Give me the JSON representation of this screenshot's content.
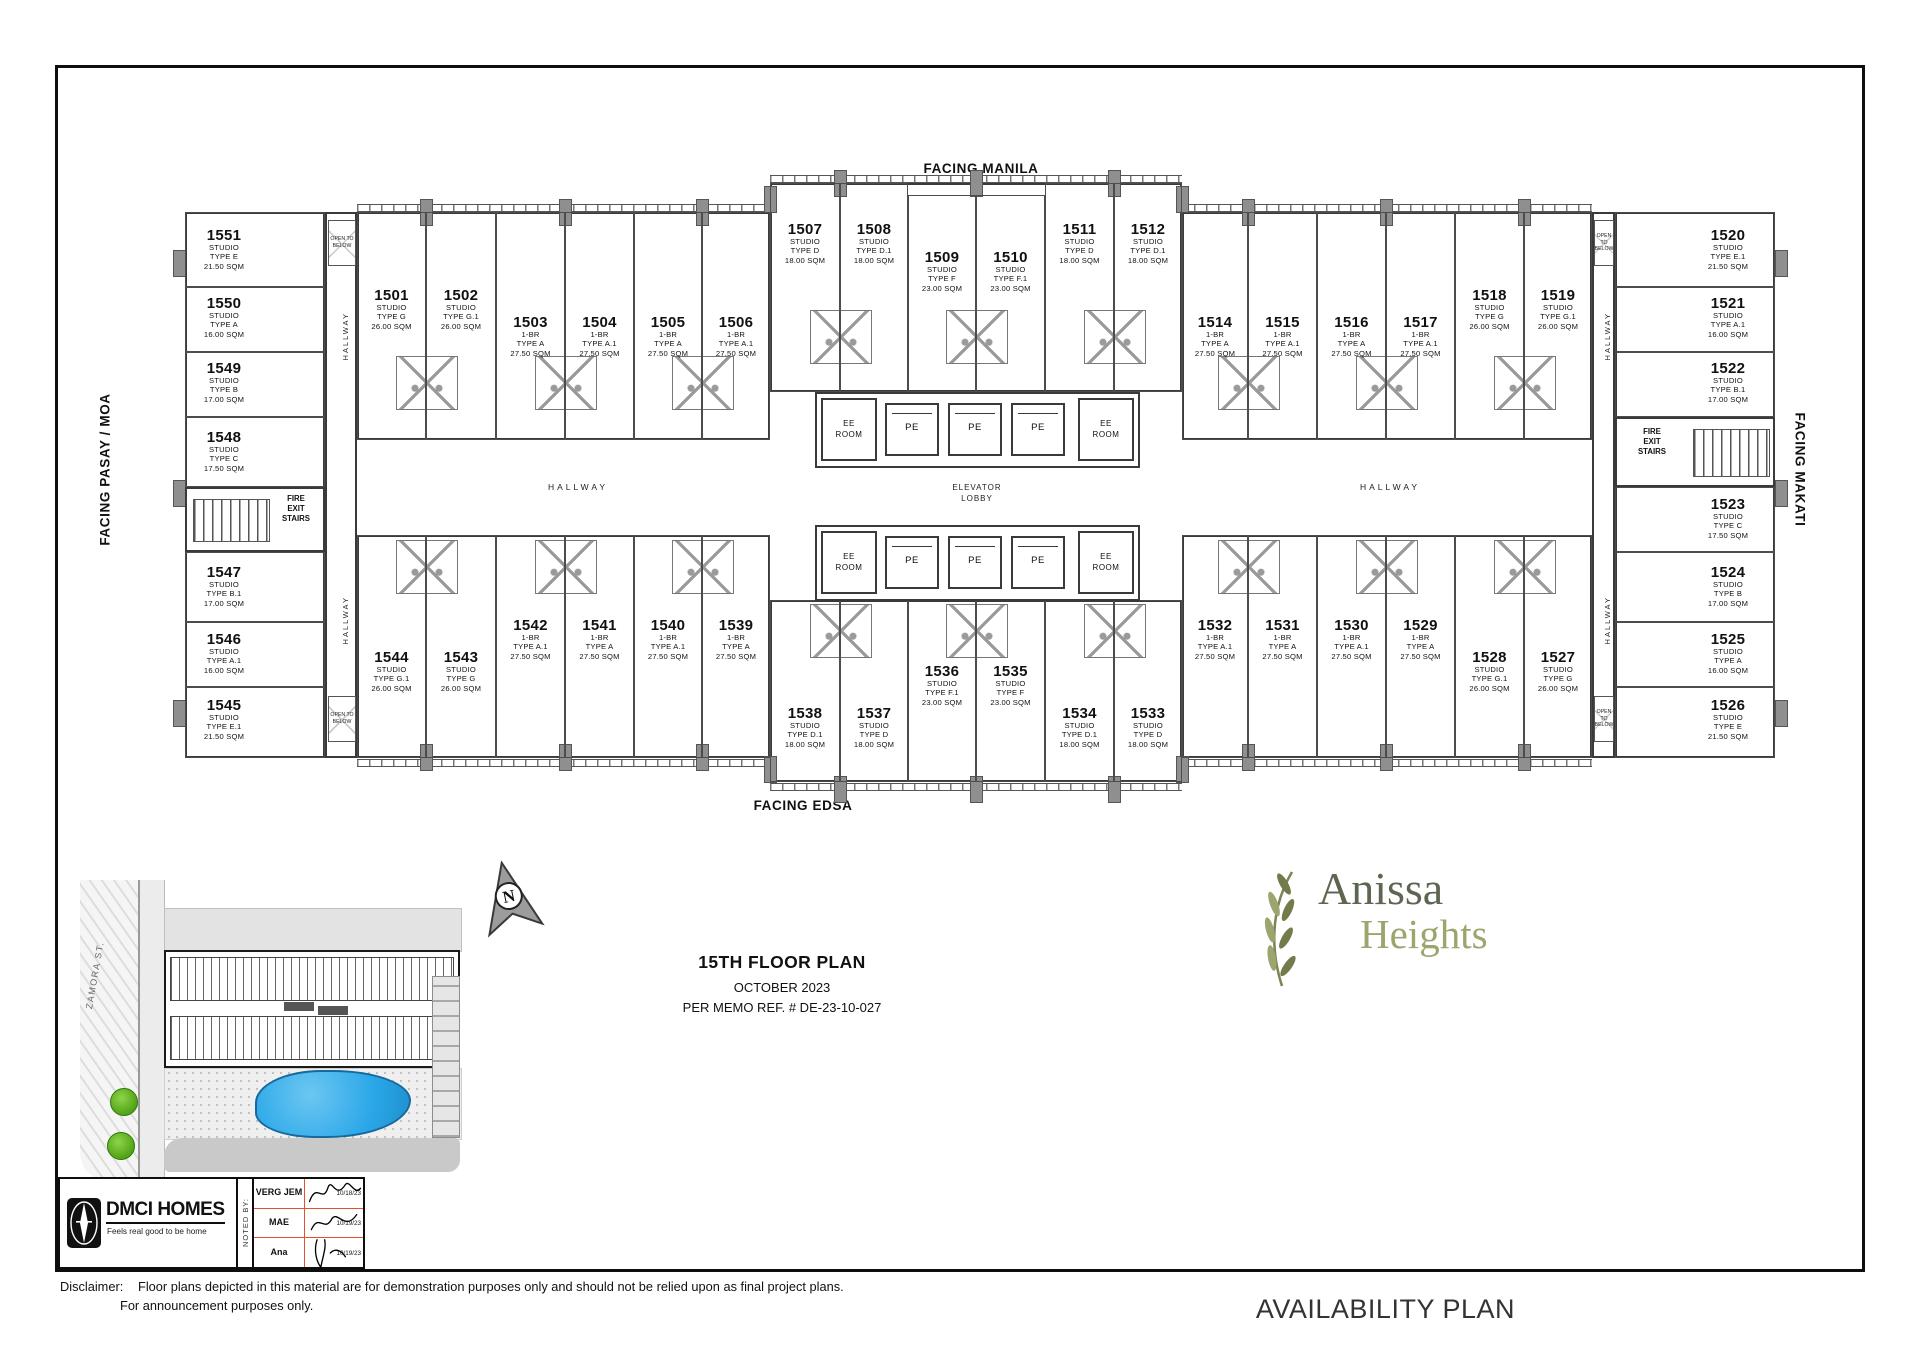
{
  "plan": {
    "facing": {
      "top": "FACING MANILA",
      "bottom": "FACING EDSA",
      "left": "FACING PASAY / MOA",
      "right": "FACING MAKATI"
    },
    "hallway_label": "HALLWAY",
    "elevator_lobby": [
      "ELEVATOR",
      "LOBBY"
    ],
    "ee_room": [
      "EE",
      "ROOM"
    ],
    "pe": "PE",
    "fire_exit_stairs": [
      "FIRE",
      "EXIT",
      "STAIRS"
    ],
    "open_to_below": [
      "OPEN",
      "TO",
      "BELOW"
    ],
    "units": [
      {
        "no": "1501",
        "t": [
          "STUDIO",
          "TYPE G",
          "26.00 SQM"
        ],
        "x": 357,
        "y": 212,
        "w": 69,
        "h": 228,
        "ly": 288
      },
      {
        "no": "1502",
        "t": [
          "STUDIO",
          "TYPE G.1",
          "26.00 SQM"
        ],
        "x": 426,
        "y": 212,
        "w": 70,
        "h": 228,
        "ly": 288
      },
      {
        "no": "1503",
        "t": [
          "1-BR",
          "TYPE A",
          "27.50 SQM"
        ],
        "x": 496,
        "y": 212,
        "w": 69,
        "h": 228,
        "ly": 315
      },
      {
        "no": "1504",
        "t": [
          "1-BR",
          "TYPE A.1",
          "27.50 SQM"
        ],
        "x": 565,
        "y": 212,
        "w": 69,
        "h": 228,
        "ly": 315
      },
      {
        "no": "1505",
        "t": [
          "1-BR",
          "TYPE A",
          "27.50 SQM"
        ],
        "x": 634,
        "y": 212,
        "w": 68,
        "h": 228,
        "ly": 315
      },
      {
        "no": "1506",
        "t": [
          "1-BR",
          "TYPE A.1",
          "27.50 SQM"
        ],
        "x": 702,
        "y": 212,
        "w": 68,
        "h": 228,
        "ly": 315
      },
      {
        "no": "1507",
        "t": [
          "STUDIO",
          "TYPE D",
          "18.00 SQM"
        ],
        "x": 770,
        "y": 183,
        "w": 70,
        "h": 209,
        "ly": 222
      },
      {
        "no": "1508",
        "t": [
          "STUDIO",
          "TYPE D.1",
          "18.00 SQM"
        ],
        "x": 840,
        "y": 183,
        "w": 68,
        "h": 209,
        "ly": 222
      },
      {
        "no": "1509",
        "t": [
          "STUDIO",
          "TYPE F",
          "23.00 SQM"
        ],
        "x": 908,
        "y": 195,
        "w": 68,
        "h": 197,
        "ly": 250
      },
      {
        "no": "1510",
        "t": [
          "STUDIO",
          "TYPE F.1",
          "23.00 SQM"
        ],
        "x": 976,
        "y": 195,
        "w": 69,
        "h": 197,
        "ly": 250
      },
      {
        "no": "1511",
        "t": [
          "STUDIO",
          "TYPE D",
          "18.00 SQM"
        ],
        "x": 1045,
        "y": 183,
        "w": 69,
        "h": 209,
        "ly": 222
      },
      {
        "no": "1512",
        "t": [
          "STUDIO",
          "TYPE D.1",
          "18.00 SQM"
        ],
        "x": 1114,
        "y": 183,
        "w": 68,
        "h": 209,
        "ly": 222
      },
      {
        "no": "1514",
        "t": [
          "1-BR",
          "TYPE A",
          "27.50 SQM"
        ],
        "x": 1182,
        "y": 212,
        "w": 66,
        "h": 228,
        "ly": 315
      },
      {
        "no": "1515",
        "t": [
          "1-BR",
          "TYPE A.1",
          "27.50 SQM"
        ],
        "x": 1248,
        "y": 212,
        "w": 69,
        "h": 228,
        "ly": 315
      },
      {
        "no": "1516",
        "t": [
          "1-BR",
          "TYPE A",
          "27.50 SQM"
        ],
        "x": 1317,
        "y": 212,
        "w": 69,
        "h": 228,
        "ly": 315
      },
      {
        "no": "1517",
        "t": [
          "1-BR",
          "TYPE A.1",
          "27.50 SQM"
        ],
        "x": 1386,
        "y": 212,
        "w": 69,
        "h": 228,
        "ly": 315
      },
      {
        "no": "1518",
        "t": [
          "STUDIO",
          "TYPE G",
          "26.00 SQM"
        ],
        "x": 1455,
        "y": 212,
        "w": 69,
        "h": 228,
        "ly": 288
      },
      {
        "no": "1519",
        "t": [
          "STUDIO",
          "TYPE G.1",
          "26.00 SQM"
        ],
        "x": 1524,
        "y": 212,
        "w": 68,
        "h": 228,
        "ly": 288
      },
      {
        "no": "1544",
        "t": [
          "STUDIO",
          "TYPE G.1",
          "26.00 SQM"
        ],
        "x": 357,
        "y": 535,
        "w": 69,
        "h": 223,
        "ly": 650
      },
      {
        "no": "1543",
        "t": [
          "STUDIO",
          "TYPE G",
          "26.00 SQM"
        ],
        "x": 426,
        "y": 535,
        "w": 70,
        "h": 223,
        "ly": 650
      },
      {
        "no": "1542",
        "t": [
          "1-BR",
          "TYPE A.1",
          "27.50 SQM"
        ],
        "x": 496,
        "y": 535,
        "w": 69,
        "h": 223,
        "ly": 618
      },
      {
        "no": "1541",
        "t": [
          "1-BR",
          "TYPE A",
          "27.50 SQM"
        ],
        "x": 565,
        "y": 535,
        "w": 69,
        "h": 223,
        "ly": 618
      },
      {
        "no": "1540",
        "t": [
          "1-BR",
          "TYPE A.1",
          "27.50 SQM"
        ],
        "x": 634,
        "y": 535,
        "w": 68,
        "h": 223,
        "ly": 618
      },
      {
        "no": "1539",
        "t": [
          "1-BR",
          "TYPE A",
          "27.50 SQM"
        ],
        "x": 702,
        "y": 535,
        "w": 68,
        "h": 223,
        "ly": 618
      },
      {
        "no": "1538",
        "t": [
          "STUDIO",
          "TYPE D.1",
          "18.00 SQM"
        ],
        "x": 770,
        "y": 600,
        "w": 70,
        "h": 182,
        "ly": 706
      },
      {
        "no": "1537",
        "t": [
          "STUDIO",
          "TYPE D",
          "18.00 SQM"
        ],
        "x": 840,
        "y": 600,
        "w": 68,
        "h": 182,
        "ly": 706
      },
      {
        "no": "1536",
        "t": [
          "STUDIO",
          "TYPE F.1",
          "23.00 SQM"
        ],
        "x": 908,
        "y": 600,
        "w": 68,
        "h": 182,
        "ly": 664
      },
      {
        "no": "1535",
        "t": [
          "STUDIO",
          "TYPE F",
          "23.00 SQM"
        ],
        "x": 976,
        "y": 600,
        "w": 69,
        "h": 182,
        "ly": 664
      },
      {
        "no": "1534",
        "t": [
          "STUDIO",
          "TYPE D.1",
          "18.00 SQM"
        ],
        "x": 1045,
        "y": 600,
        "w": 69,
        "h": 182,
        "ly": 706
      },
      {
        "no": "1533",
        "t": [
          "STUDIO",
          "TYPE D",
          "18.00 SQM"
        ],
        "x": 1114,
        "y": 600,
        "w": 68,
        "h": 182,
        "ly": 706
      },
      {
        "no": "1532",
        "t": [
          "1-BR",
          "TYPE A.1",
          "27.50 SQM"
        ],
        "x": 1182,
        "y": 535,
        "w": 66,
        "h": 223,
        "ly": 618
      },
      {
        "no": "1531",
        "t": [
          "1-BR",
          "TYPE A",
          "27.50 SQM"
        ],
        "x": 1248,
        "y": 535,
        "w": 69,
        "h": 223,
        "ly": 618
      },
      {
        "no": "1530",
        "t": [
          "1-BR",
          "TYPE A.1",
          "27.50 SQM"
        ],
        "x": 1317,
        "y": 535,
        "w": 69,
        "h": 223,
        "ly": 618
      },
      {
        "no": "1529",
        "t": [
          "1-BR",
          "TYPE A",
          "27.50 SQM"
        ],
        "x": 1386,
        "y": 535,
        "w": 69,
        "h": 223,
        "ly": 618
      },
      {
        "no": "1528",
        "t": [
          "STUDIO",
          "TYPE G.1",
          "26.00 SQM"
        ],
        "x": 1455,
        "y": 535,
        "w": 69,
        "h": 223,
        "ly": 650
      },
      {
        "no": "1527",
        "t": [
          "STUDIO",
          "TYPE G",
          "26.00 SQM"
        ],
        "x": 1524,
        "y": 535,
        "w": 68,
        "h": 223,
        "ly": 650
      },
      {
        "no": "1551",
        "t": [
          "STUDIO",
          "TYPE E",
          "21.50 SQM"
        ],
        "x": 185,
        "y": 212,
        "w": 140,
        "h": 75,
        "ly": 228,
        "lx": 224
      },
      {
        "no": "1550",
        "t": [
          "STUDIO",
          "TYPE A",
          "16.00 SQM"
        ],
        "x": 185,
        "y": 287,
        "w": 140,
        "h": 65,
        "ly": 296,
        "lx": 224
      },
      {
        "no": "1549",
        "t": [
          "STUDIO",
          "TYPE B",
          "17.00 SQM"
        ],
        "x": 185,
        "y": 352,
        "w": 140,
        "h": 65,
        "ly": 361,
        "lx": 224
      },
      {
        "no": "1548",
        "t": [
          "STUDIO",
          "TYPE C",
          "17.50 SQM"
        ],
        "x": 185,
        "y": 417,
        "w": 140,
        "h": 70,
        "ly": 430,
        "lx": 224
      },
      {
        "no": "1547",
        "t": [
          "STUDIO",
          "TYPE B.1",
          "17.00 SQM"
        ],
        "x": 185,
        "y": 552,
        "w": 140,
        "h": 70,
        "ly": 565,
        "lx": 224
      },
      {
        "no": "1546",
        "t": [
          "STUDIO",
          "TYPE A.1",
          "16.00 SQM"
        ],
        "x": 185,
        "y": 622,
        "w": 140,
        "h": 65,
        "ly": 632,
        "lx": 224
      },
      {
        "no": "1545",
        "t": [
          "STUDIO",
          "TYPE E.1",
          "21.50 SQM"
        ],
        "x": 185,
        "y": 687,
        "w": 140,
        "h": 71,
        "ly": 698,
        "lx": 224
      },
      {
        "no": "1520",
        "t": [
          "STUDIO",
          "TYPE E.1",
          "21.50 SQM"
        ],
        "x": 1615,
        "y": 212,
        "w": 160,
        "h": 75,
        "ly": 228,
        "lx": 1728
      },
      {
        "no": "1521",
        "t": [
          "STUDIO",
          "TYPE A.1",
          "16.00 SQM"
        ],
        "x": 1615,
        "y": 287,
        "w": 160,
        "h": 65,
        "ly": 296,
        "lx": 1728
      },
      {
        "no": "1522",
        "t": [
          "STUDIO",
          "TYPE B.1",
          "17.00 SQM"
        ],
        "x": 1615,
        "y": 352,
        "w": 160,
        "h": 65,
        "ly": 361,
        "lx": 1728
      },
      {
        "no": "1523",
        "t": [
          "STUDIO",
          "TYPE C",
          "17.50 SQM"
        ],
        "x": 1615,
        "y": 487,
        "w": 160,
        "h": 65,
        "ly": 497,
        "lx": 1728
      },
      {
        "no": "1524",
        "t": [
          "STUDIO",
          "TYPE B",
          "17.00 SQM"
        ],
        "x": 1615,
        "y": 552,
        "w": 160,
        "h": 70,
        "ly": 565,
        "lx": 1728
      },
      {
        "no": "1525",
        "t": [
          "STUDIO",
          "TYPE A",
          "16.00 SQM"
        ],
        "x": 1615,
        "y": 622,
        "w": 160,
        "h": 65,
        "ly": 632,
        "lx": 1728
      },
      {
        "no": "1526",
        "t": [
          "STUDIO",
          "TYPE E",
          "21.50 SQM"
        ],
        "x": 1615,
        "y": 687,
        "w": 160,
        "h": 71,
        "ly": 698,
        "lx": 1728
      }
    ]
  },
  "geometry": {
    "blocks": [
      {
        "x": 185,
        "y": 212,
        "w": 140,
        "h": 546
      },
      {
        "x": 1615,
        "y": 212,
        "w": 160,
        "h": 546
      },
      {
        "x": 325,
        "y": 212,
        "w": 32,
        "h": 546
      },
      {
        "x": 1592,
        "y": 212,
        "w": 23,
        "h": 546
      },
      {
        "x": 357,
        "y": 212,
        "w": 413,
        "h": 228
      },
      {
        "x": 1182,
        "y": 212,
        "w": 410,
        "h": 228
      },
      {
        "x": 357,
        "y": 535,
        "w": 413,
        "h": 223
      },
      {
        "x": 1182,
        "y": 535,
        "w": 410,
        "h": 223
      },
      {
        "x": 770,
        "y": 183,
        "w": 412,
        "h": 209
      },
      {
        "x": 770,
        "y": 600,
        "w": 412,
        "h": 182
      }
    ],
    "balconies": [
      {
        "x": 357,
        "y": 204,
        "w": 413
      },
      {
        "x": 1182,
        "y": 204,
        "w": 410
      },
      {
        "x": 770,
        "y": 175,
        "w": 412
      },
      {
        "x": 357,
        "y": 759,
        "w": 413
      },
      {
        "x": 1182,
        "y": 759,
        "w": 410
      },
      {
        "x": 770,
        "y": 783,
        "w": 412
      }
    ],
    "piers": [
      {
        "x": 426,
        "y": 199
      },
      {
        "x": 565,
        "y": 199
      },
      {
        "x": 702,
        "y": 199
      },
      {
        "x": 1248,
        "y": 199
      },
      {
        "x": 1386,
        "y": 199
      },
      {
        "x": 1524,
        "y": 199
      },
      {
        "x": 840,
        "y": 170
      },
      {
        "x": 976,
        "y": 170
      },
      {
        "x": 1114,
        "y": 170
      },
      {
        "x": 770,
        "y": 186
      },
      {
        "x": 1182,
        "y": 186
      },
      {
        "x": 426,
        "y": 744
      },
      {
        "x": 565,
        "y": 744
      },
      {
        "x": 702,
        "y": 744
      },
      {
        "x": 1248,
        "y": 744
      },
      {
        "x": 1386,
        "y": 744
      },
      {
        "x": 1524,
        "y": 744
      },
      {
        "x": 840,
        "y": 776
      },
      {
        "x": 976,
        "y": 776
      },
      {
        "x": 1114,
        "y": 776
      },
      {
        "x": 770,
        "y": 756
      },
      {
        "x": 1182,
        "y": 756
      },
      {
        "x": 179,
        "y": 250
      },
      {
        "x": 179,
        "y": 480
      },
      {
        "x": 179,
        "y": 700
      },
      {
        "x": 1781,
        "y": 250
      },
      {
        "x": 1781,
        "y": 480
      },
      {
        "x": 1781,
        "y": 700
      }
    ],
    "baths": [
      {
        "x": 426,
        "y": 356
      },
      {
        "x": 565,
        "y": 356
      },
      {
        "x": 702,
        "y": 356
      },
      {
        "x": 1248,
        "y": 356
      },
      {
        "x": 1386,
        "y": 356
      },
      {
        "x": 1524,
        "y": 356
      },
      {
        "x": 840,
        "y": 310
      },
      {
        "x": 976,
        "y": 310
      },
      {
        "x": 1114,
        "y": 310
      },
      {
        "x": 426,
        "y": 540
      },
      {
        "x": 565,
        "y": 540
      },
      {
        "x": 702,
        "y": 540
      },
      {
        "x": 1248,
        "y": 540
      },
      {
        "x": 1386,
        "y": 540
      },
      {
        "x": 1524,
        "y": 540
      },
      {
        "x": 840,
        "y": 604
      },
      {
        "x": 976,
        "y": 604
      },
      {
        "x": 1114,
        "y": 604
      }
    ],
    "stairs": [
      {
        "x": 185,
        "y": 487,
        "w": 140,
        "h": 65,
        "tx": 8,
        "lx": 296,
        "ly": 494
      },
      {
        "x": 1615,
        "y": 417,
        "w": 160,
        "h": 70,
        "tx": 78,
        "lx": 1652,
        "ly": 427
      }
    ],
    "open_below": [
      {
        "x": 328,
        "y": 220,
        "w": 28,
        "h": 46
      },
      {
        "x": 328,
        "y": 696,
        "w": 28,
        "h": 46
      },
      {
        "x": 1594,
        "y": 220,
        "w": 20,
        "h": 46
      },
      {
        "x": 1594,
        "y": 696,
        "w": 20,
        "h": 46
      }
    ],
    "hallways_h": [
      {
        "x": 578,
        "y": 482
      },
      {
        "x": 1390,
        "y": 482
      }
    ],
    "hallways_v": [
      {
        "x": 341,
        "y": 312
      },
      {
        "x": 341,
        "y": 596
      },
      {
        "x": 1603,
        "y": 312
      },
      {
        "x": 1603,
        "y": 596
      }
    ],
    "core": {
      "banks": [
        {
          "x": 815,
          "y": 392,
          "w": 325,
          "h": 76
        },
        {
          "x": 815,
          "y": 525,
          "w": 325,
          "h": 76
        }
      ],
      "pe_x": [
        912,
        975,
        1038
      ],
      "ee_x": [
        849,
        1106
      ],
      "lobby": {
        "x": 977,
        "y": 483
      }
    }
  },
  "site_plan": {
    "street": "ZAMORA ST.",
    "north_label": "N"
  },
  "title_block": {
    "brand": "DMCI HOMES",
    "tagline": "Feels real good to be home",
    "noted_by": "NOTED BY:",
    "signatories": [
      {
        "name": "VERG JEM",
        "date": "10/18/23"
      },
      {
        "name": "MAE",
        "date": "10/19/23"
      },
      {
        "name": "Ana",
        "date": "10/19/23"
      }
    ]
  },
  "title": {
    "floor": "15TH FLOOR PLAN",
    "month": "OCTOBER 2023",
    "memo": "PER MEMO REF. # DE-23-10-027"
  },
  "logo": {
    "line1": "Anissa",
    "line2": "Heights",
    "color1": "#5d6651",
    "color2": "#9aa66d"
  },
  "availability_label": "AVAILABILITY PLAN",
  "disclaimer": {
    "label": "Disclaimer:",
    "line1": "Floor plans depicted in this material are for demonstration purposes only and should not be relied upon as final project plans.",
    "line2": "For announcement purposes only."
  }
}
